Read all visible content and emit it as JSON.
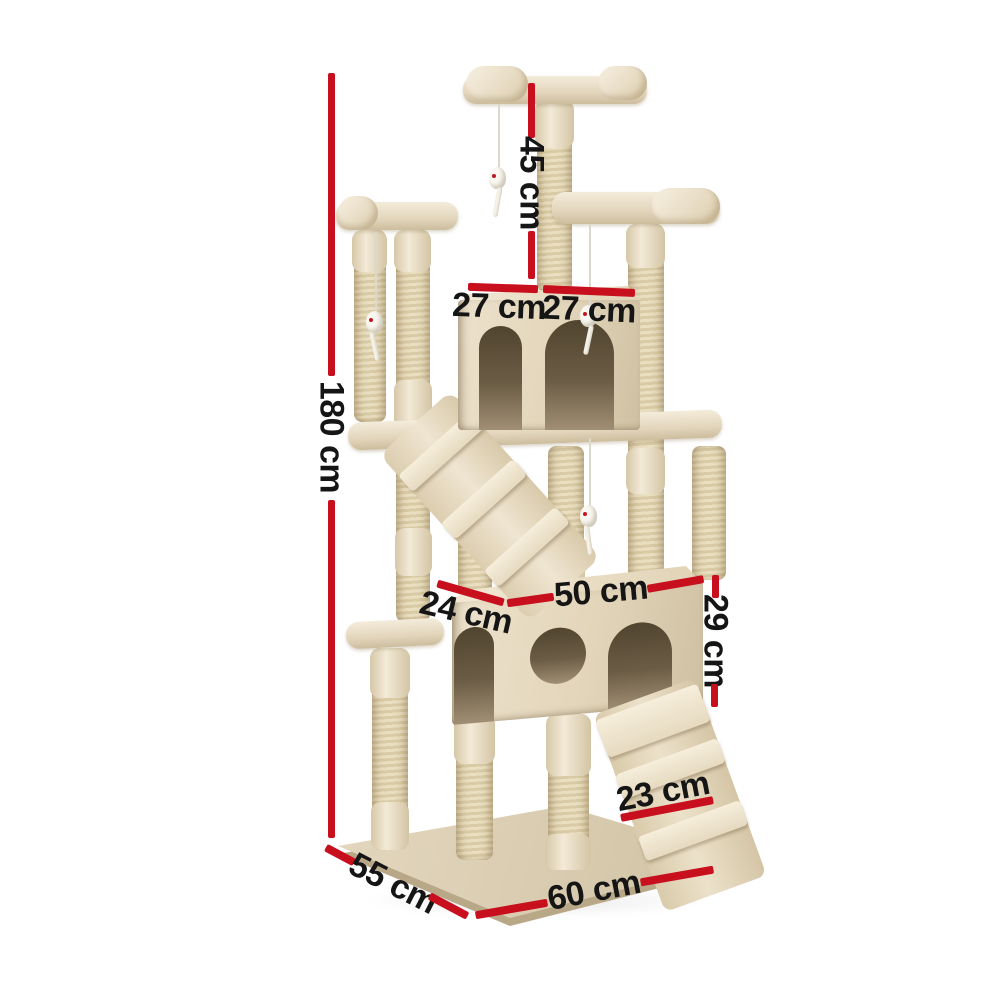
{
  "image_kind": "product dimension diagram",
  "product": {
    "kind": "cat tree scratching post",
    "finish": "beige plush and sisal"
  },
  "colors": {
    "background": "#ffffff",
    "dimension_line_red": "#c70f1e",
    "label_text": "#151515",
    "plush_beige": "#e9decb",
    "sisal_beige": "#e0d2ae"
  },
  "dimensions": {
    "total_height": "180 cm",
    "top_level_height": "45 cm",
    "condo_left_width": "27 cm",
    "condo_right_width": "27 cm",
    "house_width": "50 cm",
    "house_depth": "24 cm",
    "house_height": "29 cm",
    "ramp_width": "23 cm",
    "base_depth": "55 cm",
    "base_width": "60 cm"
  }
}
